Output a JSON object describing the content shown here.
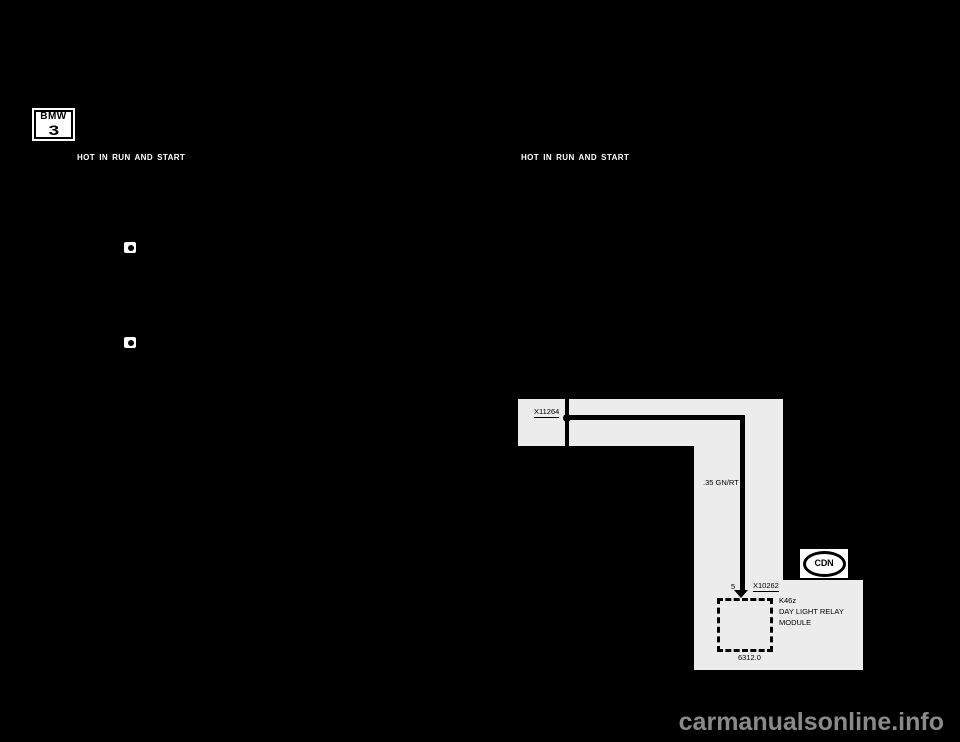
{
  "page": {
    "background": "#000000",
    "watermark_text": "carmanualsonline.info",
    "watermark_color": "#8a8a8a"
  },
  "badge": {
    "brand": "BMW",
    "series": "3"
  },
  "power_labels": {
    "left": "HOT IN RUN AND START",
    "right": "HOT IN RUN AND START"
  },
  "icons": {
    "ref1": "page-reference-icon",
    "ref2": "page-reference-icon"
  },
  "diagram": {
    "background": "#ececec",
    "wire_color": "#000000",
    "splice_label": "X11264",
    "wire_label": ".35 GN/RT",
    "pin": "5",
    "connector_label": "X10262",
    "module_code": "K46z",
    "module_line1": "DAY LIGHT RELAY",
    "module_line2": "MODULE",
    "circuit_ref": "6312.0",
    "market_badge": "CDN"
  }
}
